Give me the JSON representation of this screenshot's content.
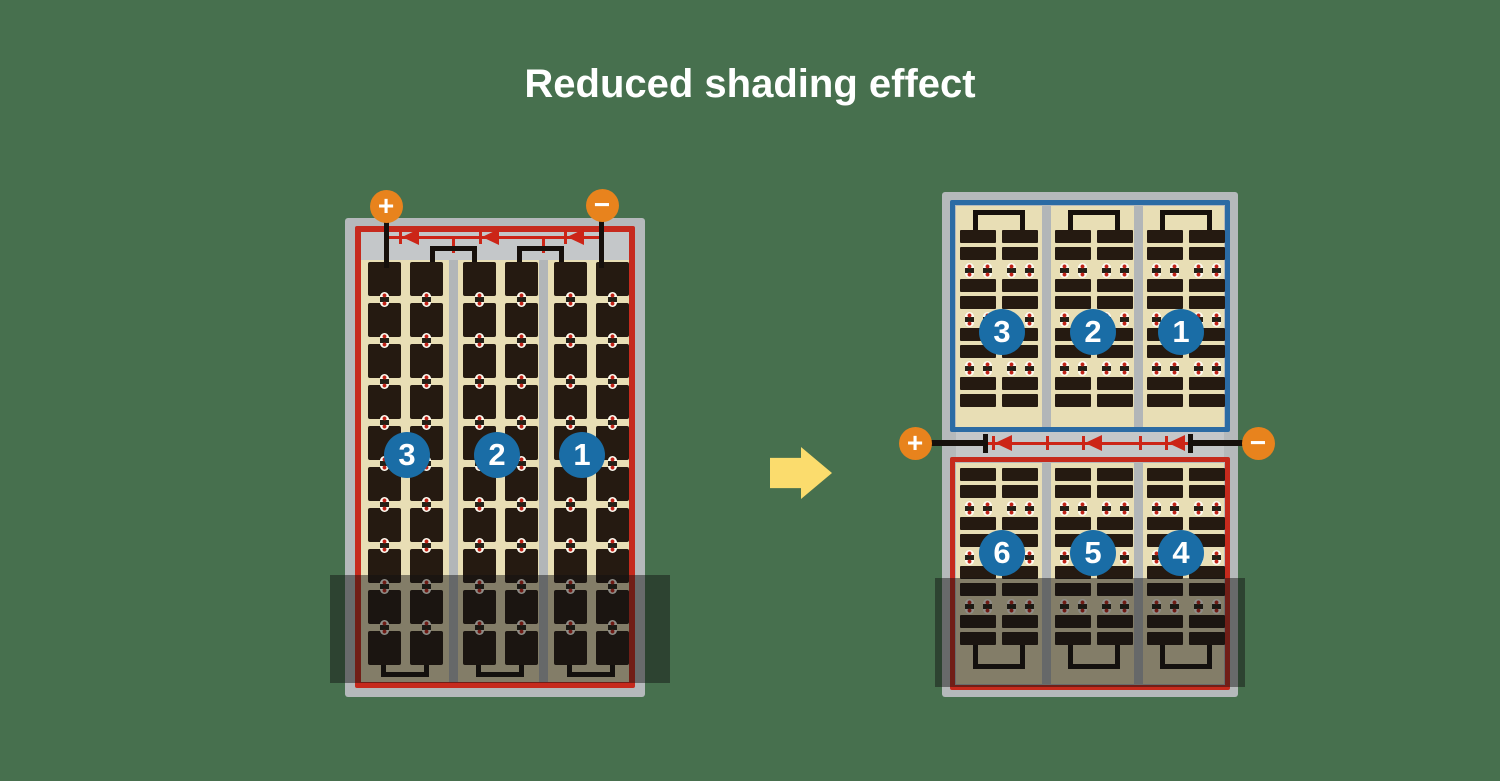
{
  "title": "Reduced shading effect",
  "colors": {
    "background": "#47704e",
    "panel_frame": "#b5b9bb",
    "strip_gray": "#c4c7c9",
    "divider_gray": "#b2b6b8",
    "cell_area_tan": "#e8deb5",
    "cell_dark": "#251a11",
    "border_red": "#c62a1d",
    "border_blue": "#2b6ba4",
    "diode_red": "#cc2517",
    "terminal_orange": "#e8831d",
    "number_circle_blue": "#1a6da6",
    "arrow_yellow": "#fbdc6d",
    "wire_black": "#16100c",
    "shade": "rgba(17,17,17,0.47)"
  },
  "left_panel": {
    "positive_terminal": "+",
    "negative_terminal": "−",
    "string_labels": [
      "3",
      "2",
      "1"
    ]
  },
  "right_panel": {
    "positive_terminal": "+",
    "negative_terminal": "−",
    "top_string_labels": [
      "3",
      "2",
      "1"
    ],
    "bottom_string_labels": [
      "6",
      "5",
      "4"
    ]
  },
  "icons": {
    "arrow": "right-block-arrow",
    "diode": "left-pointing-diode"
  }
}
